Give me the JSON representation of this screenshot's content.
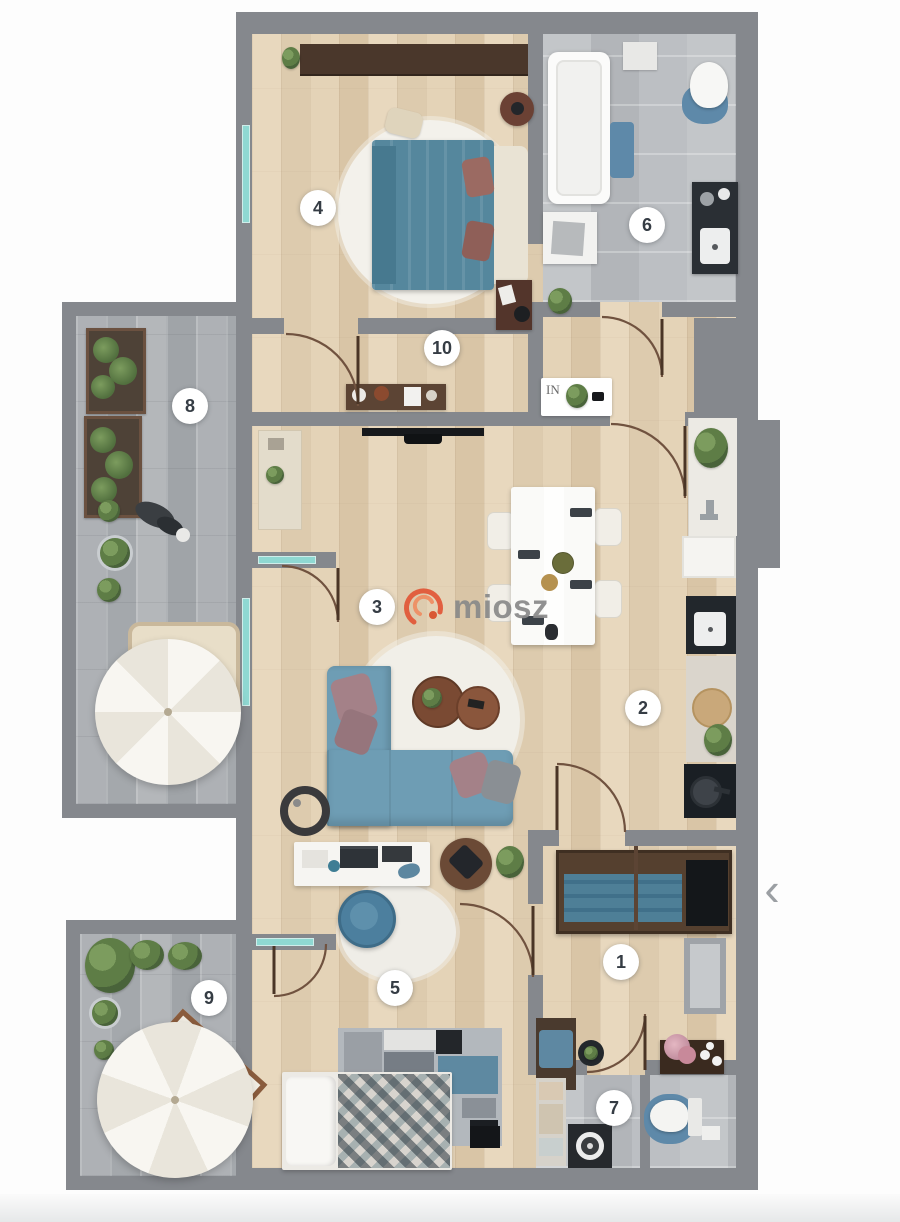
{
  "watermark": {
    "brand": "miosz"
  },
  "carousel": {
    "prev_label": "‹"
  },
  "floorplan": {
    "entry_mat_label": "IN",
    "rooms": [
      {
        "number": "1"
      },
      {
        "number": "2"
      },
      {
        "number": "3"
      },
      {
        "number": "4"
      },
      {
        "number": "5"
      },
      {
        "number": "6"
      },
      {
        "number": "7"
      },
      {
        "number": "8"
      },
      {
        "number": "9"
      },
      {
        "number": "10"
      }
    ]
  },
  "palette": {
    "wall": "#85888D",
    "wood_floor": "#E4D3B7",
    "bathroom_tile": "#BFC2C6",
    "terrace_paver": "#ABAFB3",
    "accent_blue": "#5E89A9",
    "furniture_brown": "#55402F",
    "window_teal": "#8FD8D2",
    "logo_orange": "#E25737",
    "watermark_gray": "#8A8A8A"
  }
}
